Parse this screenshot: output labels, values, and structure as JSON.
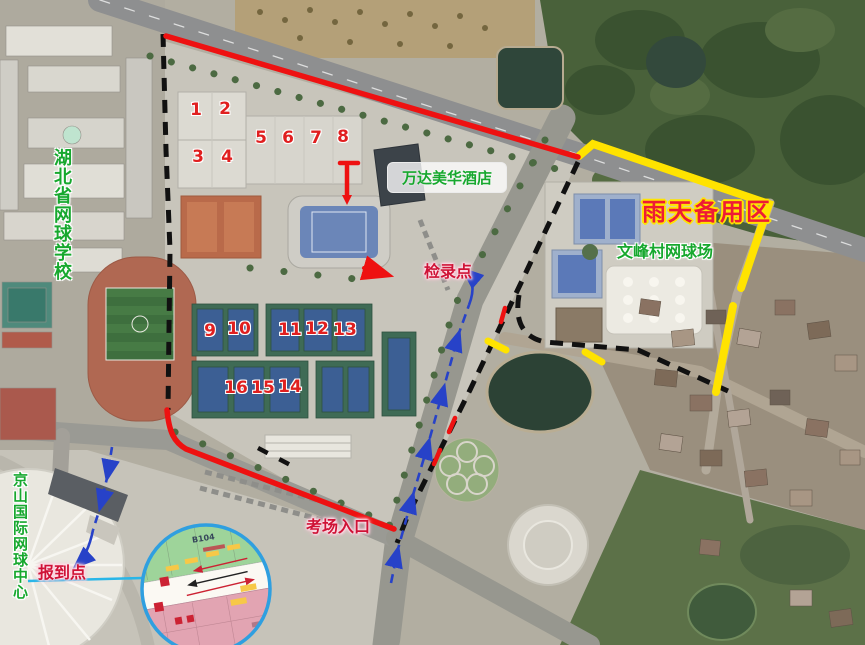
{
  "labels": {
    "school": "湖北省网球学校",
    "tennis_center": "京山国际网球中心",
    "hotel": "万达美华酒店",
    "rain_backup": "雨天备用区",
    "village_courts": "文峰村网球场",
    "check_in": "检录点",
    "exam_entrance": "考场入口",
    "report_point": "报到点"
  },
  "court_numbers": [
    "1",
    "2",
    "3",
    "4",
    "5",
    "6",
    "7",
    "8",
    "9",
    "10",
    "11",
    "12",
    "13",
    "14",
    "15",
    "16"
  ],
  "inset": {
    "building_code": "B104"
  },
  "colors": {
    "route_red": "#ee1111",
    "route_yellow": "#ffe300",
    "route_blue": "#2742c8",
    "leader_cyan": "#29b6e8",
    "boundary_black": "#111111",
    "label_green": "#17a82e",
    "label_red": "#cf1236",
    "rain_red_on_yellow": "#ee1b35",
    "court_number_red": "#e01f1f"
  }
}
